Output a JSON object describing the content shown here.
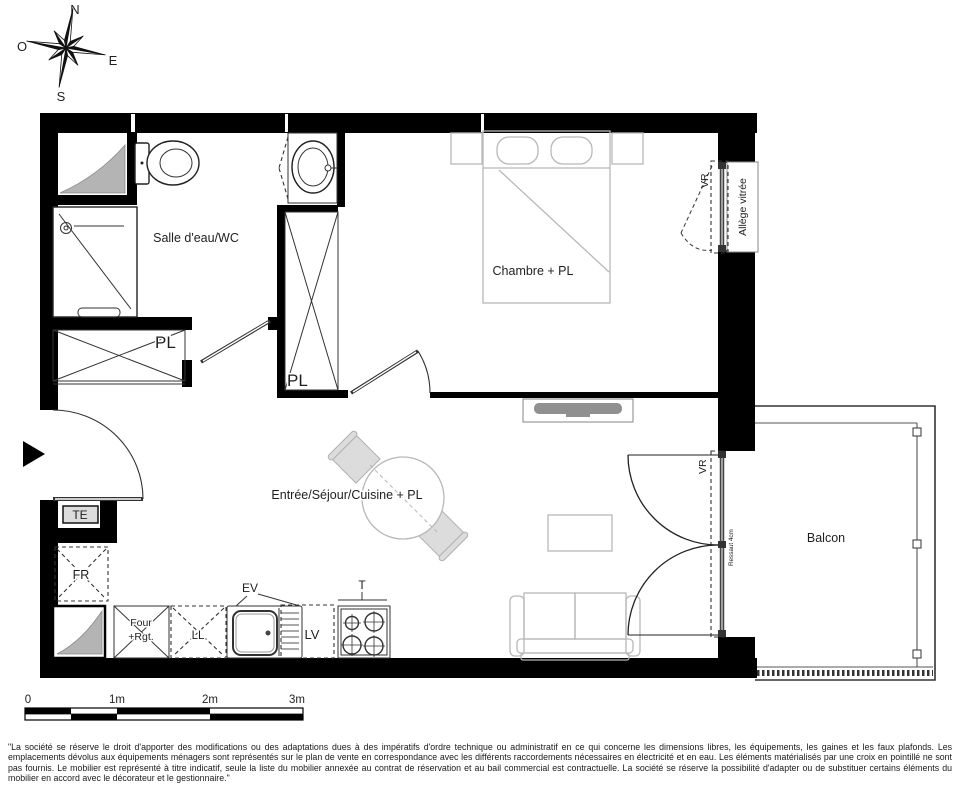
{
  "compass": {
    "north": "N",
    "west": "O",
    "east": "E",
    "south": "S"
  },
  "rooms": {
    "bathroom": "Salle d'eau/WC",
    "bedroom": "Chambre + PL",
    "living": "Entrée/Séjour/Cuisine + PL",
    "balcony": "Balcon"
  },
  "closets": {
    "bathroom_pl": "PL",
    "hall_pl": "PL"
  },
  "equipment": {
    "te": "TE",
    "fr": "FR",
    "four_line1": "Four",
    "four_line2": "+Rgt.",
    "ll": "LL",
    "ev": "EV",
    "lv": "LV",
    "hob": "T"
  },
  "openings": {
    "vr_window": "VR",
    "vr_door": "VR",
    "allege_vitree": "Allège vitrée",
    "ressaut": "Ressaut 4cm"
  },
  "scale_bar": {
    "tick0": "0",
    "tick1": "1m",
    "tick2": "2m",
    "tick3": "3m"
  },
  "disclaimer": "\"La société se réserve le droit d'apporter des modifications ou des adaptations dues à des impératifs d'ordre technique ou administratif en ce qui concerne les dimensions libres, les équipements, les gaines et les faux plafonds. Les emplacements dévolus aux équipements ménagers sont représentés sur le plan de vente en correspondance avec les différents raccordements nécessaires en électricité et en eau. Les éléments matérialisés par une croix en pointillé ne sont pas fournis. Le mobilier est représenté à titre indicatif, seule la liste du mobilier annexée au contrat de réservation et au bail commercial est contractuelle. La société se réserve la possibilité d'adapter ou de substituer certains éléments du mobilier en accord avec le décorateur et le gestionnaire.\"",
  "colors": {
    "walls": "#000000",
    "furniture_outline": "#b8b8b8",
    "shaft_fill": "#b4b4b4",
    "label_text": "#1f1f1f"
  }
}
